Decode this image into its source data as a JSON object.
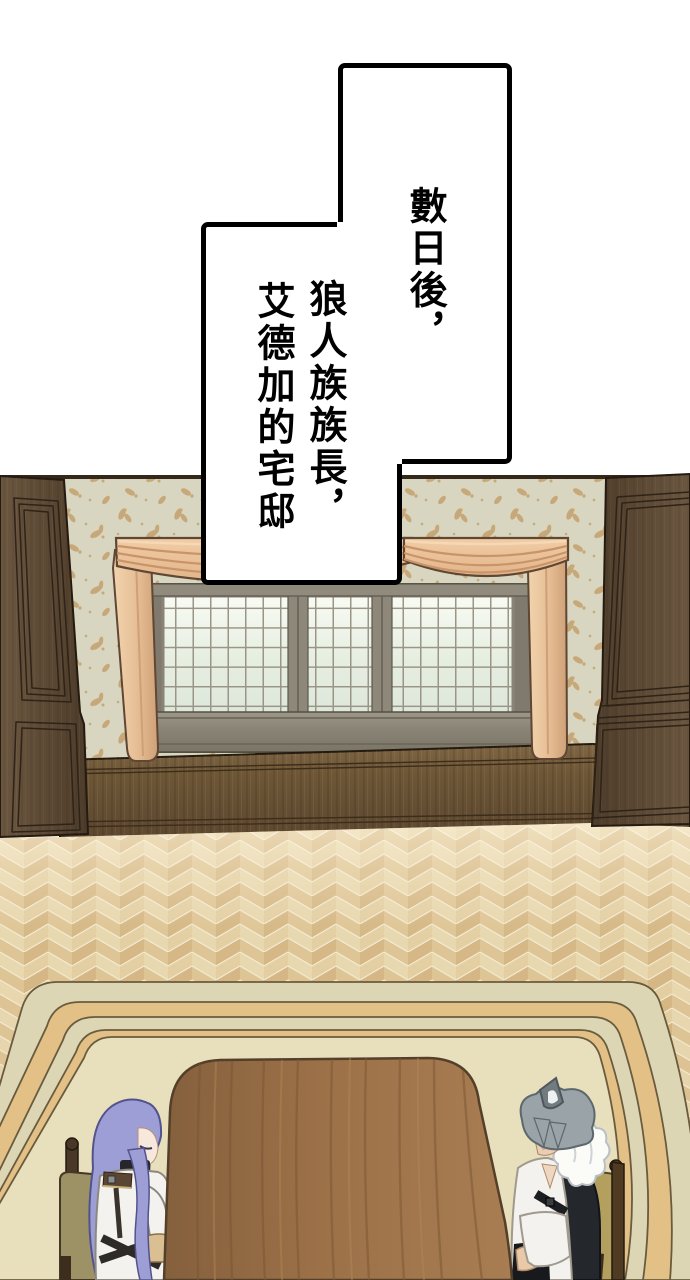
{
  "narration": {
    "lines": [
      "數日後，",
      "狼人族族長，",
      "艾德加的宅邸"
    ]
  },
  "palette": {
    "wall_line": "#33281a",
    "wallpaper_bg": "#d8d6c0",
    "wallpaper_floral": "#c3a06c",
    "wood_dark": "#5d4b38",
    "curtain": "#eac29a",
    "curtain_shadow": "#c9946a",
    "window_frame": "#8e887b",
    "glass_light": "#f8fbf3",
    "glass_dark": "#dde7da",
    "wainscot": "#6e5737",
    "floor_light": "#ecdfc0",
    "floor_mid": "#d8bd8e",
    "rug_cream": "#ddd6b5",
    "rug_gold": "#e3c186",
    "rug_field": "#e8dfbd",
    "table_wood": "#9c7148",
    "hair_left": "#9e9ed6",
    "hair_right": "#9aa4a8",
    "outfit_white": "#f4f2ee",
    "cape_black": "#24272b",
    "chair_olive": "#9c9266",
    "chair_gold": "#b3a05f",
    "text_color": "#000000"
  }
}
